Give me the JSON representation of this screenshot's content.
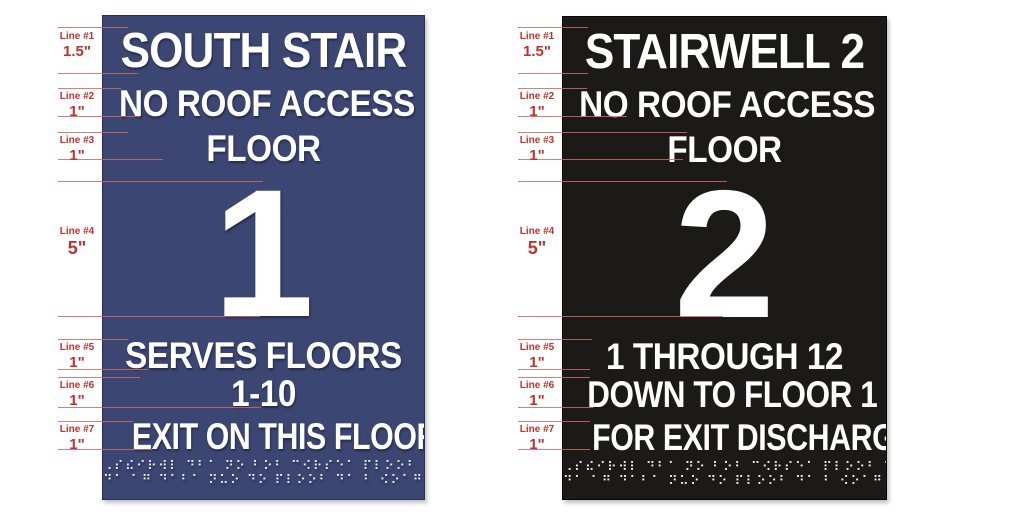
{
  "canvas": {
    "width": 1024,
    "height": 512,
    "background": "#ffffff"
  },
  "annotation": {
    "text_color": "#c2312d",
    "leader_line_color": "#cf6a64",
    "rows": [
      {
        "label": "Line #1",
        "value": "1.5\""
      },
      {
        "label": "Line #2",
        "value": "1\""
      },
      {
        "label": "Line #3",
        "value": "1\""
      },
      {
        "label": "Line #4",
        "value": "5\""
      },
      {
        "label": "Line #5",
        "value": "1\""
      },
      {
        "label": "Line #6",
        "value": "1\""
      },
      {
        "label": "Line #7",
        "value": "1\""
      }
    ]
  },
  "signs": [
    {
      "id": "south-stair-sign",
      "background": "#3c4672",
      "text_color": "#ffffff",
      "title": "SOUTH STAIR",
      "line2": "NO ROOF ACCESS",
      "line3": "FLOOR",
      "number": "1",
      "line5": "SERVES FLOORS",
      "line6": "1-10",
      "line7": "EXIT ON THIS FLOOR",
      "braille1": "⠠⠎⠮⠊⠗⠺⠇ ⠙⠃⠁ ⠝⠕ ⠃⠕⠃ ⠉⠪⠗⠎⠑⠁ ⠏⠇⠕⠕⠃ ⠙⠃⠁",
      "braille2": "⠙⠁ ⠁⠛ ⠙⠁⠃⠁ ⠝⠥⠕ ⠙⠕ ⠏⠇⠕⠕⠃ ⠙⠁ ⠃ ⠪⠕⠁⠛ ⠁⠥⠙⠃⠎"
    },
    {
      "id": "stairwell-2-sign",
      "background": "#1c1a19",
      "text_color": "#ffffff",
      "title": "STAIRWELL 2",
      "line2": "NO ROOF ACCESS",
      "line3": "FLOOR",
      "number": "2",
      "line5": "1 THROUGH 12",
      "line6": "DOWN TO FLOOR 1",
      "line7": "FOR EXIT DISCHARGE",
      "braille1": "⠠⠎⠮⠊⠗⠺⠇ ⠙⠃⠁ ⠝⠕ ⠃⠕⠃ ⠉⠪⠗⠎⠑⠁ ⠏⠇⠕⠕⠃ ⠙⠃⠁",
      "braille2": "⠙⠁ ⠁⠛ ⠙⠁⠃⠁ ⠝⠥⠕ ⠙⠕ ⠏⠇⠕⠕⠃ ⠙⠁ ⠃ ⠪⠕⠁⠛ ⠁⠥⠙⠃⠎"
    }
  ]
}
